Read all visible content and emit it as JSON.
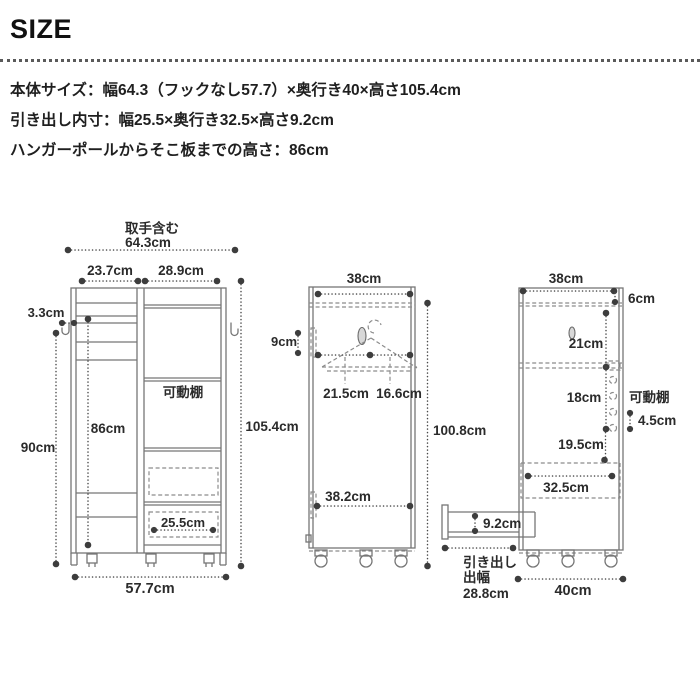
{
  "page": {
    "title": "SIZE"
  },
  "specs": {
    "body_size": "本体サイズ：幅64.3（フックなし57.7）×奥行き40×高さ105.4cm",
    "drawer_size": "引き出し内寸：幅25.5×奥行き32.5×高さ9.2cm",
    "pole_height": "ハンガーポールからそこ板までの高さ：86cm"
  },
  "front_view": {
    "handle_note": "取手含む",
    "width_total": "64.3cm",
    "width_left": "23.7cm",
    "width_right": "28.9cm",
    "hook_depth": "3.3cm",
    "pole_to_base": "86cm",
    "side_height": "90cm",
    "shelf_label": "可動棚",
    "drawer_width": "25.5cm",
    "height_total": "105.4cm",
    "width_body": "57.7cm"
  },
  "side_view_hanger": {
    "depth": "38cm",
    "pole_drop": "9cm",
    "front_to_pole": "21.5cm",
    "pole_to_back": "16.6cm",
    "inner_depth": "38.2cm",
    "inner_height": "100.8cm"
  },
  "side_view_shelf": {
    "depth": "38cm",
    "top_gap": "6cm",
    "section_upper": "21cm",
    "section_middle": "18cm",
    "shelf_label": "可動棚",
    "hole_pitch": "4.5cm",
    "section_lower": "19.5cm",
    "drawer_depth": "32.5cm",
    "drawer_inner_height": "9.2cm",
    "drawer_ext_line1": "引き出し",
    "drawer_ext_line2": "出幅",
    "drawer_ext_value": "28.8cm",
    "depth_total": "40cm"
  },
  "colors": {
    "line": "#767676",
    "dot": "#3d3d3d",
    "text": "#2b2b2b"
  }
}
